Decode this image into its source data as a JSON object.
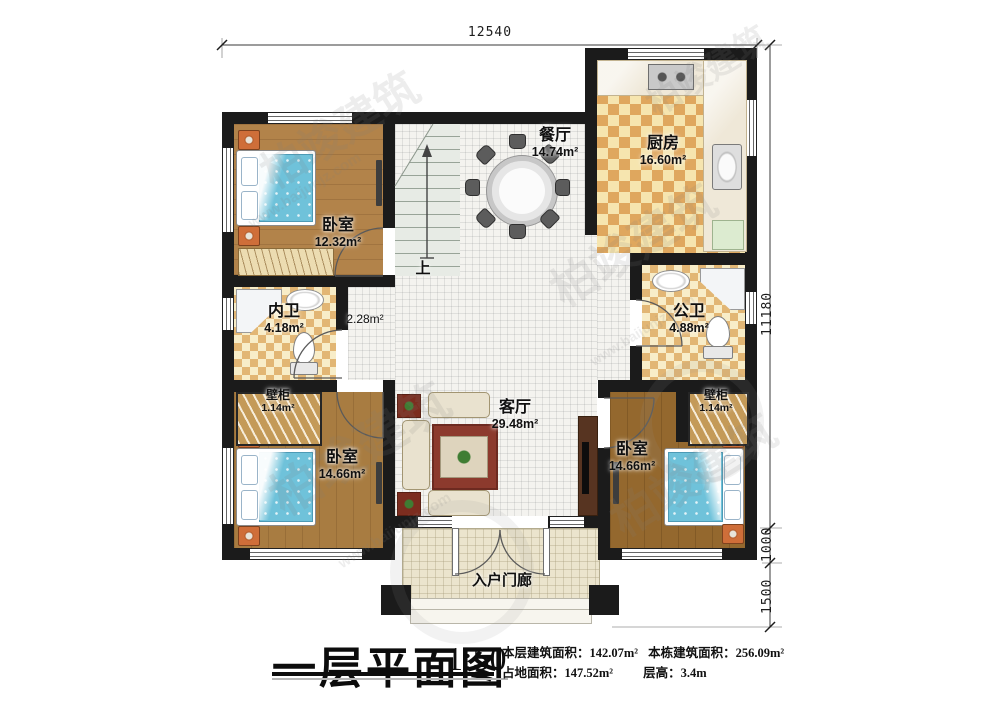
{
  "watermark": {
    "brand": "柏竣建筑",
    "url": "www.baijunjz.com"
  },
  "dims": {
    "top": "12540",
    "right_main": "11180",
    "right_mid": "1000",
    "right_bottom": "1500"
  },
  "rooms": {
    "bedroom_tl": {
      "name": "卧室",
      "area": "12.32m²"
    },
    "dining": {
      "name": "餐厅",
      "area": "14.74m²"
    },
    "kitchen": {
      "name": "厨房",
      "area": "16.60m²"
    },
    "inner_bath": {
      "name": "内卫",
      "area": "4.18m²"
    },
    "hall": {
      "area": "2.28m²"
    },
    "public_bath": {
      "name": "公卫",
      "area": "4.88m²"
    },
    "closet_left": {
      "name": "壁柜",
      "area": "1.14m²"
    },
    "closet_right": {
      "name": "壁柜",
      "area": "1.14m²"
    },
    "bedroom_bl": {
      "name": "卧室",
      "area": "14.66m²"
    },
    "living": {
      "name": "客厅",
      "area": "29.48m²"
    },
    "bedroom_br": {
      "name": "卧室",
      "area": "14.66m²"
    },
    "porch": {
      "name": "入户门廊"
    }
  },
  "stairs": {
    "up_label": "上"
  },
  "title_block": {
    "title": "一层平面图",
    "scale": "1:50",
    "stats": [
      {
        "label": "本层建筑面积：",
        "value": "142.07m²"
      },
      {
        "label": "本栋建筑面积：",
        "value": "256.09m²"
      },
      {
        "label": "占地面积：",
        "value": "147.52m²"
      },
      {
        "label": "层高：",
        "value": "3.4m"
      }
    ]
  }
}
